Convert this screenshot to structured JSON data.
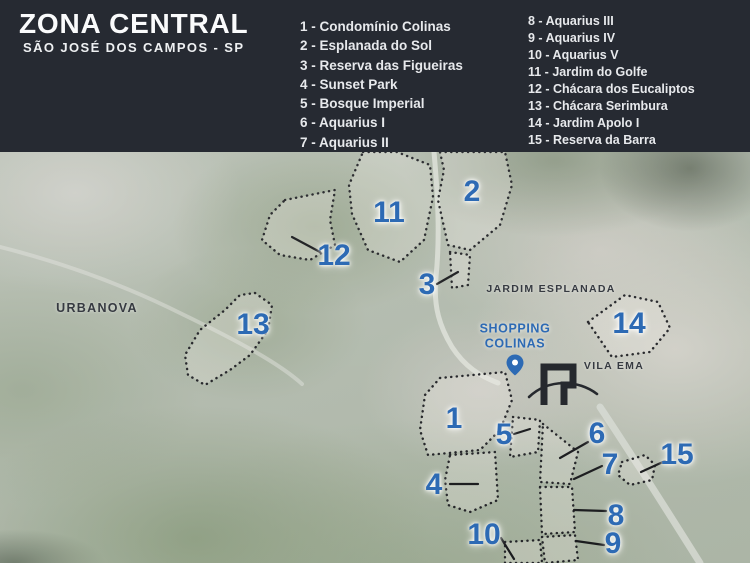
{
  "header": {
    "title": "ZONA CENTRAL",
    "subtitle": "SÃO JOSÉ DOS CAMPOS - SP",
    "legend": {
      "col1": [
        "1 - Condomínio Colinas",
        "2 - Esplanada do Sol",
        "3 - Reserva das Figueiras",
        "4 - Sunset Park",
        "5 - Bosque Imperial",
        "6 - Aquarius I",
        "7 - Aquarius II"
      ],
      "col2": [
        "8 - Aquarius III",
        "9 - Aquarius IV",
        "10 - Aquarius V",
        "11 - Jardim do Golfe",
        "12 - Chácara dos Eucaliptos",
        "13 - Chácara Serimbura",
        "14 - Jardim Apolo I",
        "15 - Reserva da Barra"
      ]
    }
  },
  "map": {
    "markers": [
      "1",
      "2",
      "3",
      "4",
      "5",
      "6",
      "7",
      "8",
      "9",
      "10",
      "11",
      "12",
      "13",
      "14",
      "15"
    ],
    "labels": {
      "urbanova": "URBANOVA",
      "jardim_esplanada": "JARDIM ESPLANADA",
      "vila_ema": "VILA EMA",
      "shopping_line1": "SHOPPING",
      "shopping_line2": "COLINAS"
    },
    "icons": {
      "pin": "location-pin-icon",
      "logo": "arch-monument-logo-icon"
    },
    "colors": {
      "accent_blue": "#2d6ab4",
      "header_bg": "#262a32",
      "outline_dark": "#17181c",
      "map_label_dark": "#363a41"
    }
  }
}
